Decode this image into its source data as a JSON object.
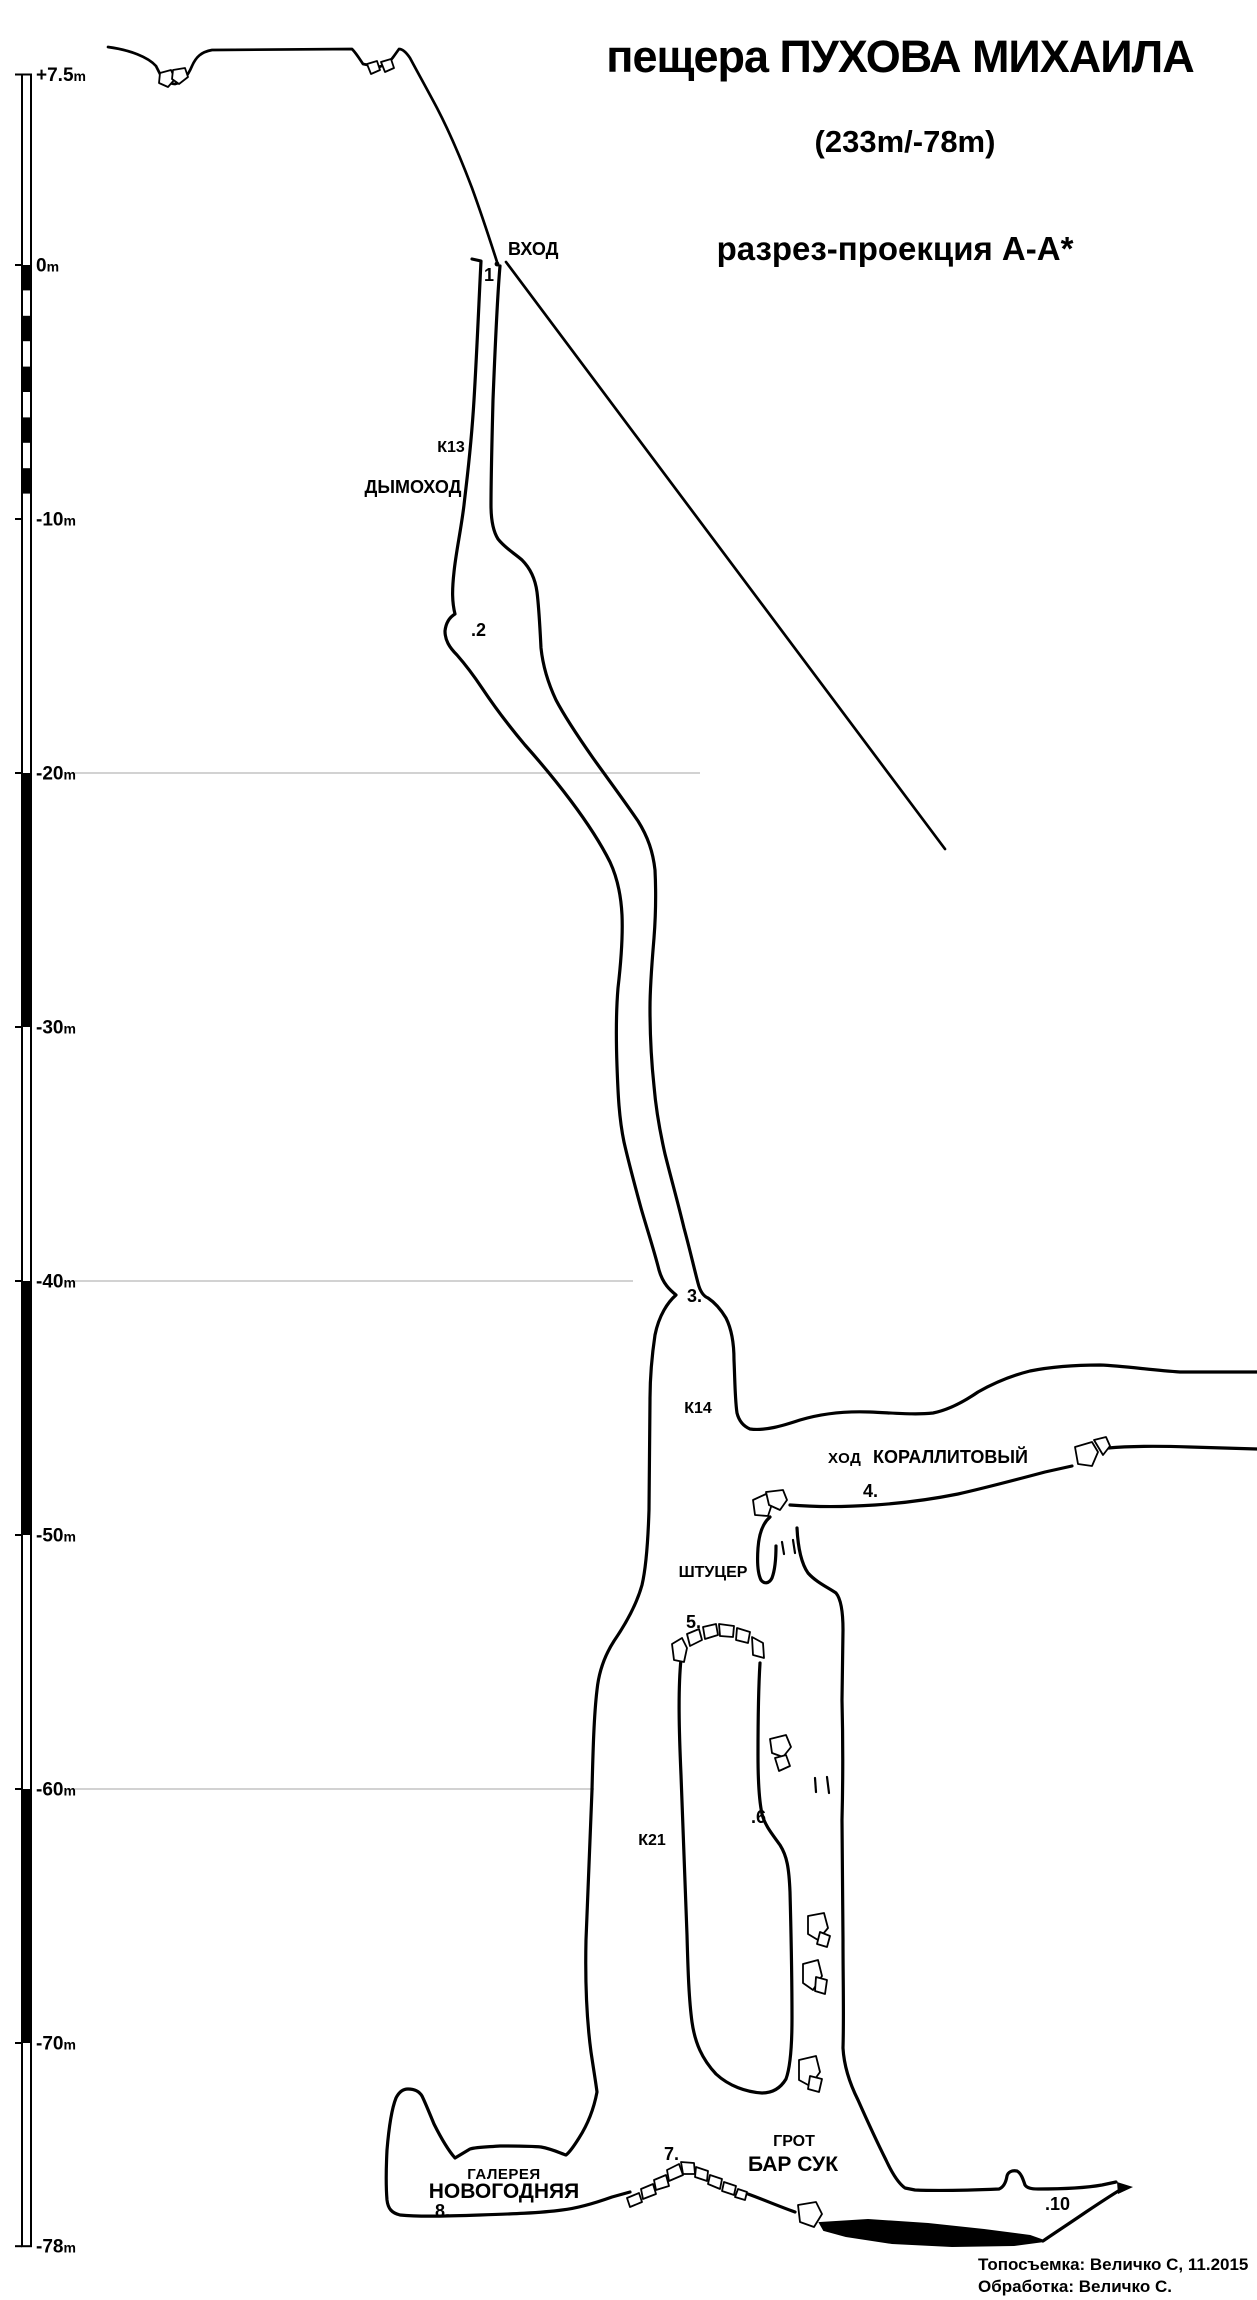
{
  "title": {
    "prefix": "пещера",
    "name": "ПУХОВА МИХАИЛА",
    "full": "пещера ПУХОВА МИХАИЛА",
    "stats": "(233m/-78m)",
    "projection": "разрез-проекция А-А*"
  },
  "scale": {
    "unit": "m",
    "ticks": [
      {
        "value": 7.5,
        "label": "+7.5m"
      },
      {
        "value": 0,
        "label": "0m"
      },
      {
        "value": -10,
        "label": "-10m"
      },
      {
        "value": -20,
        "label": "-20m"
      },
      {
        "value": -30,
        "label": "-30m"
      },
      {
        "value": -40,
        "label": "-40m"
      },
      {
        "value": -50,
        "label": "-50m"
      },
      {
        "value": -60,
        "label": "-60m"
      },
      {
        "value": -70,
        "label": "-70m"
      },
      {
        "value": -78,
        "label": "-78m"
      }
    ],
    "black_bands": [
      [
        0,
        -1
      ],
      [
        -2,
        -3
      ],
      [
        -4,
        -5
      ],
      [
        -6,
        -7
      ],
      [
        -8,
        -9
      ],
      [
        -20,
        -30
      ],
      [
        -40,
        -50
      ],
      [
        -60,
        -70
      ]
    ]
  },
  "labels": {
    "entrance": "ВХОД",
    "k13": "К13",
    "chimney": "ДЫМОХОД",
    "k14": "К14",
    "passage_word": "ХОД",
    "passage_name": "КОРАЛЛИТОВЫЙ",
    "shtutser": "ШТУЦЕР",
    "k21": "К21",
    "grotto_word": "ГРОТ",
    "grotto_name": "БАР СУК",
    "gallery_word": "ГАЛЕРЕЯ",
    "gallery_name": "НОВОГОДНЯЯ"
  },
  "stations": {
    "s1": "1",
    "s2": ".2",
    "s3": "3.",
    "s4": "4.",
    "s5": "5.",
    "s6": ".6",
    "s7": "7.",
    "s8": "8.",
    "s10": ".10"
  },
  "credits": {
    "survey": "Топосъемка: Величко С, 11.2015",
    "processing": "Обработка: Величко С."
  },
  "colors": {
    "ink": "#000000",
    "reference_line": "#c4c4c4",
    "background": "#ffffff"
  }
}
